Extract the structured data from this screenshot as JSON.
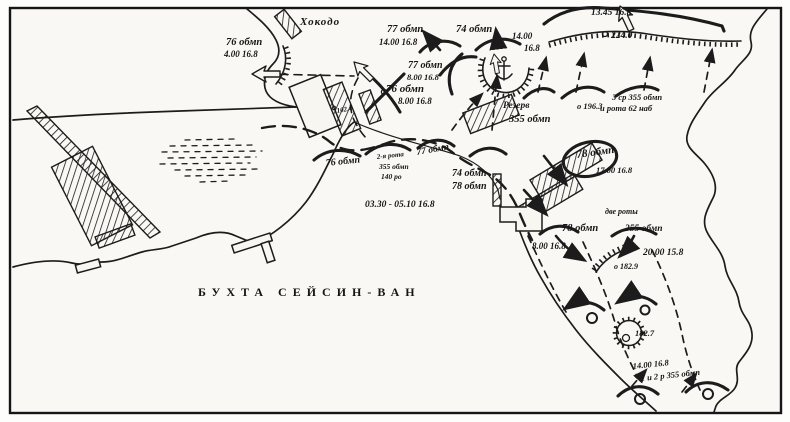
{
  "map": {
    "bay_label": "БУХТА  СЕЙСИН-ВАН",
    "place": {
      "hokodo": "Хокодо"
    },
    "units": {
      "u76_n": {
        "name": "76 обмп",
        "time": "4.00 16.8"
      },
      "u77_n": {
        "name": "77 обмп",
        "time": "14.00 16.8"
      },
      "u74_n": {
        "name": "74 обмп",
        "time": "14.00",
        "time2": "16.8"
      },
      "u77_c": {
        "name": "77 обмп",
        "time": "8.00 16.8"
      },
      "u76_c": {
        "name": "76 обмп",
        "time": "8.00 16.8"
      },
      "reserve": {
        "line1": "Резерв",
        "line2": "355 обмп"
      },
      "gr355": {
        "line1": "3 ср 355 обмп",
        "line2": "и рота 62 наб"
      },
      "u76_line": {
        "name": "76 обмп"
      },
      "gr140": {
        "line1": "2-я рота",
        "line2": "355 обмп",
        "line3": "140 ро"
      },
      "u77_line": {
        "name": "77 обмп"
      },
      "u74_line": {
        "name": "74 обмп"
      },
      "u78_line": {
        "name": "78 обмп"
      },
      "u78_e": {
        "name": "78 обмп",
        "time": "17.00 16.8"
      },
      "two_companies": "две роты",
      "u78_s": {
        "name": "78 обмп",
        "time": "8.00 16.8"
      },
      "u355_e": {
        "name": "355 обмп",
        "time": "20.00 15.8"
      },
      "gr12": {
        "time": "14.00 16.8",
        "name": "1 и 2 р 355 обмп"
      }
    },
    "times": {
      "t1345": "13.45 16.8",
      "t_landing": "03.30 - 05.10 16.8"
    },
    "heights": {
      "h224": "224.0",
      "h196": "о 196.3",
      "h102": "102.4",
      "h1829": "о 182.9",
      "h1827": "182.7"
    },
    "colors": {
      "ink": "#1c1c1c",
      "paper": "#fdfdfb"
    }
  }
}
